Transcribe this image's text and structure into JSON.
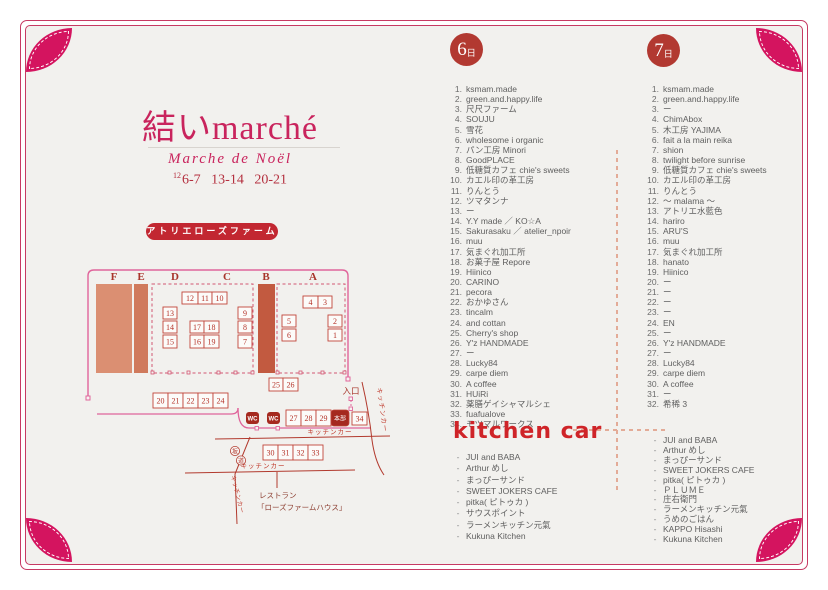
{
  "header": {
    "title": "結いmarché",
    "subtitle": "Marche de Noël",
    "date_month": "12",
    "dates": "6-7 13-14 20-21",
    "venue_button": "アトリエローズファーム"
  },
  "colors": {
    "accent_crimson": "#c9245d",
    "frame_pink": "#c73a63",
    "petal": "#d4145f",
    "badge_red": "#b23931",
    "pill_red": "#c22731",
    "kitchen_red": "#cf2428",
    "map_red": "#b5352b",
    "map_pink": "#e0659b",
    "list_text": "#5f5f5f"
  },
  "map": {
    "sections": [
      [
        "F",
        29
      ],
      [
        "E",
        56
      ],
      [
        "D",
        90
      ],
      [
        "C",
        142
      ],
      [
        "B",
        181
      ],
      [
        "A",
        228
      ]
    ],
    "blocks": [
      [
        "F",
        11,
        22,
        36,
        89,
        "#db8f72"
      ],
      [
        "E",
        49,
        22,
        14,
        89,
        "#d07a5c"
      ],
      [
        "B",
        173,
        22,
        17,
        89,
        "#c25a40"
      ]
    ],
    "regions": [
      [
        67,
        22,
        101,
        89
      ],
      [
        192,
        22,
        68,
        89
      ]
    ],
    "gates": [
      [
        66,
        109
      ],
      [
        83,
        109
      ],
      [
        102,
        109
      ],
      [
        132,
        109
      ],
      [
        149,
        109
      ],
      [
        166,
        109
      ],
      [
        191,
        109
      ],
      [
        214,
        109
      ],
      [
        236,
        109
      ],
      [
        258,
        109
      ]
    ],
    "stalls": [
      [
        "12",
        97,
        30,
        16,
        12
      ],
      [
        "11",
        113,
        30,
        14,
        12
      ],
      [
        "10",
        127,
        30,
        15,
        12
      ],
      [
        "13",
        78,
        45,
        14,
        12
      ],
      [
        "14",
        78,
        59,
        14,
        12
      ],
      [
        "15",
        78,
        73,
        14,
        13
      ],
      [
        "17",
        105,
        59,
        14,
        12
      ],
      [
        "18",
        119,
        59,
        15,
        12
      ],
      [
        "16",
        105,
        73,
        14,
        13
      ],
      [
        "19",
        119,
        73,
        15,
        13
      ],
      [
        "9",
        153,
        45,
        14,
        12
      ],
      [
        "8",
        153,
        59,
        14,
        12
      ],
      [
        "7",
        153,
        73,
        14,
        13
      ],
      [
        "4",
        218,
        34,
        15,
        12
      ],
      [
        "3",
        233,
        34,
        14,
        12
      ],
      [
        "5",
        197,
        53,
        14,
        12
      ],
      [
        "6",
        197,
        67,
        14,
        12
      ],
      [
        "2",
        243,
        53,
        14,
        12
      ],
      [
        "1",
        243,
        67,
        14,
        12
      ],
      [
        "25",
        184,
        116,
        14,
        13
      ],
      [
        "26",
        198,
        116,
        15,
        13
      ],
      [
        "20",
        68,
        131,
        15,
        15
      ],
      [
        "21",
        83,
        131,
        15,
        15
      ],
      [
        "22",
        98,
        131,
        15,
        15
      ],
      [
        "23",
        113,
        131,
        15,
        15
      ],
      [
        "24",
        128,
        131,
        15,
        15
      ],
      [
        "27",
        201,
        148,
        15,
        16
      ],
      [
        "28",
        216,
        148,
        15,
        16
      ],
      [
        "29",
        231,
        148,
        15,
        16
      ],
      [
        "34",
        267,
        150,
        15,
        13
      ],
      [
        "30",
        178,
        183,
        15,
        15
      ],
      [
        "31",
        193,
        183,
        15,
        15
      ],
      [
        "32",
        208,
        183,
        15,
        15
      ],
      [
        "33",
        223,
        183,
        15,
        15
      ]
    ],
    "wc_positions": [
      [
        161,
        150
      ],
      [
        182,
        150
      ]
    ],
    "wc_label": "WC",
    "honbu_box": [
      246,
      148,
      18,
      16
    ],
    "honbu_label": "本部",
    "entrance_label": "入口",
    "kitchen_road_label": "キッチンカー",
    "slope_chars": [
      "坂",
      "道"
    ],
    "restaurant_line1": "レストラン",
    "restaurant_line2": "「ローズファームハウス」"
  },
  "day6": {
    "badge_num": "6",
    "badge_suffix": "日",
    "items": [
      "ksmam.made",
      "green.and.happy.life",
      "尺尺ファーム",
      "SOUJU",
      "雪花",
      "wholesome i organic",
      "パン工房 Minori",
      "GoodPLACE",
      "低糖質カフェ chie's sweets",
      "カエル印の革工房",
      "りんとう",
      "ツマタンナ",
      "ー",
      "Y.Y made ／ KO☆A",
      "Sakurasaku ／ atelier_npoir",
      "muu",
      "気まぐれ加工所",
      "お菓子屋 Repore",
      "Hiinico",
      "CARINO",
      "pecora",
      "おかゆさん",
      "tincalm",
      "and cottan",
      "Cherry's shop",
      "Y'z HANDMADE",
      "ー",
      "Lucky84",
      "carpe diem",
      "A coffee",
      "HUiRi",
      "薬膳ゲイシャマルシェ",
      "fuafualove",
      "モツマルワークス"
    ],
    "kitchen_title": "kitchen car",
    "kitchen_items": [
      "JUI and BABA",
      "Arthur めし",
      "まっぴーサンド",
      "SWEET JOKERS CAFE",
      "pitka( ピトゥカ )",
      "サウスポイント",
      "ラーメンキッチン元氣",
      "Kukuna Kitchen"
    ]
  },
  "day7": {
    "badge_num": "7",
    "badge_suffix": "日",
    "items": [
      "ksmam.made",
      "green.and.happy.life",
      "ー",
      "ChimAbox",
      "木工房 YAJIMA",
      "fait a la main reika",
      "shion",
      "twilight before sunrise",
      "低糖質カフェ chie's sweets",
      "カエル印の革工房",
      "りんとう",
      "～ malama ～",
      "アトリエ水藍色",
      "hariro",
      "ARU'S",
      "muu",
      "気まぐれ加工所",
      "hanato",
      "Hiinico",
      "ー",
      "ー",
      "ー",
      "ー",
      "EN",
      "ー",
      "Y'z HANDMADE",
      "ー",
      "Lucky84",
      "carpe diem",
      "A coffee",
      "ー",
      "希稀 3"
    ],
    "kitchen_items": [
      "JUI and BABA",
      "Arthur めし",
      "まっぴーサンド",
      "SWEET JOKERS CAFE",
      "pitka( ピトゥカ )",
      "ＰＬＵＭＥ",
      "庄右衛門",
      "ラーメンキッチン元氣",
      "うめのごはん",
      "KAPPO Hisashi",
      "Kukuna Kitchen"
    ]
  }
}
